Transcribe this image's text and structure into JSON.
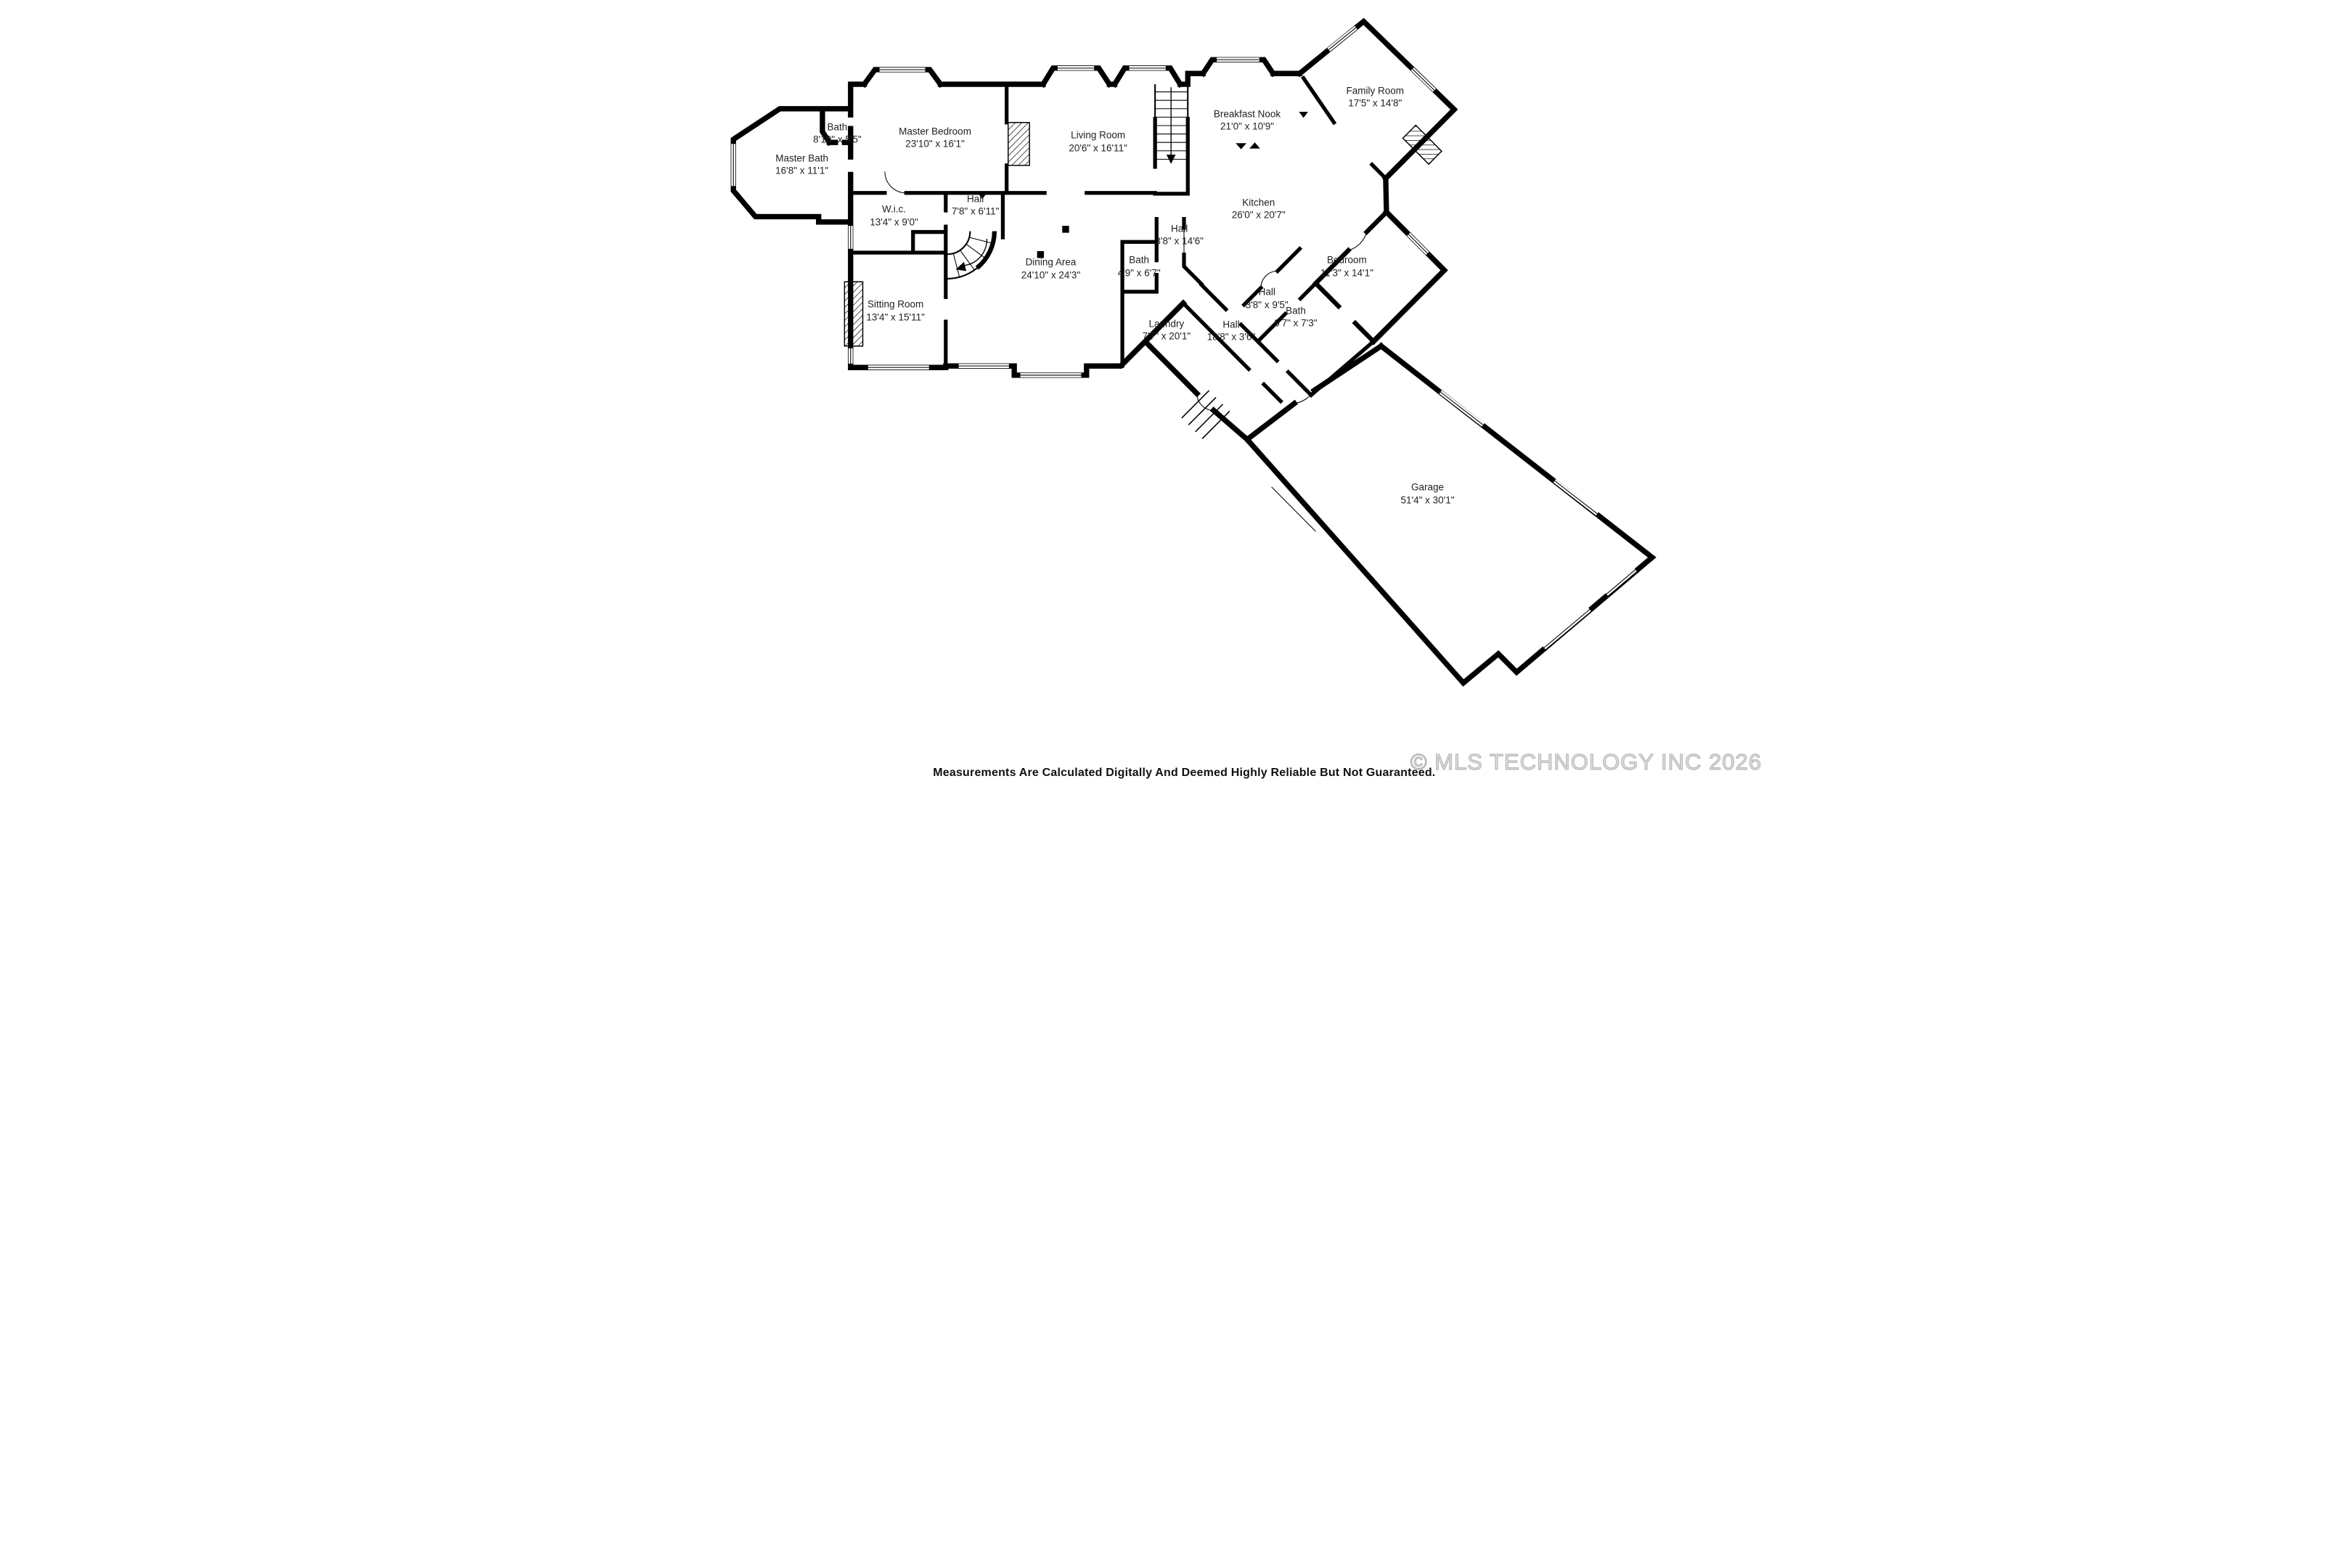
{
  "colors": {
    "wall": "#000000",
    "background": "#ffffff",
    "label_text": "#1f1f1f",
    "disclaimer_text": "#101010",
    "watermark": "#c9c9c9"
  },
  "rooms": [
    {
      "name": "Master Bath",
      "dims": "16'8\" x 11'1\""
    },
    {
      "name": "Bath",
      "dims": "8'10\" x 5'5\""
    },
    {
      "name": "Master Bedroom",
      "dims": "23'10\" x 16'1\""
    },
    {
      "name": "Living Room",
      "dims": "20'6\" x 16'11\""
    },
    {
      "name": "Breakfast Nook",
      "dims": "21'0\" x 10'9\""
    },
    {
      "name": "Family Room",
      "dims": "17'5\" x 14'8\""
    },
    {
      "name": "Kitchen",
      "dims": "26'0\" x 20'7\""
    },
    {
      "name": "Hall",
      "dims": "7'8\" x 6'11\""
    },
    {
      "name": "W.i.c.",
      "dims": "13'4\" x 9'0\""
    },
    {
      "name": "Hall",
      "dims": "3'8\" x 14'6\""
    },
    {
      "name": "Bath",
      "dims": "4'9\" x 6'7\""
    },
    {
      "name": "Dining Area",
      "dims": "24'10\" x 24'3\""
    },
    {
      "name": "Bedroom",
      "dims": "11'3\" x 14'1\""
    },
    {
      "name": "Hall",
      "dims": "3'8\" x 9'5\""
    },
    {
      "name": "Bath",
      "dims": "9'7\" x 7'3\""
    },
    {
      "name": "Sitting Room",
      "dims": "13'4\" x 15'11\""
    },
    {
      "name": "Laundry",
      "dims": "7'7\" x 20'1\""
    },
    {
      "name": "Hall",
      "dims": "18'8\" x 3'6\""
    },
    {
      "name": "Garage",
      "dims": "51'4\" x 30'1\""
    }
  ],
  "footer": {
    "disclaimer": "Measurements Are Calculated Digitally And Deemed Highly Reliable But Not Guaranteed.",
    "watermark": "© MLS TECHNOLOGY INC 2026"
  }
}
